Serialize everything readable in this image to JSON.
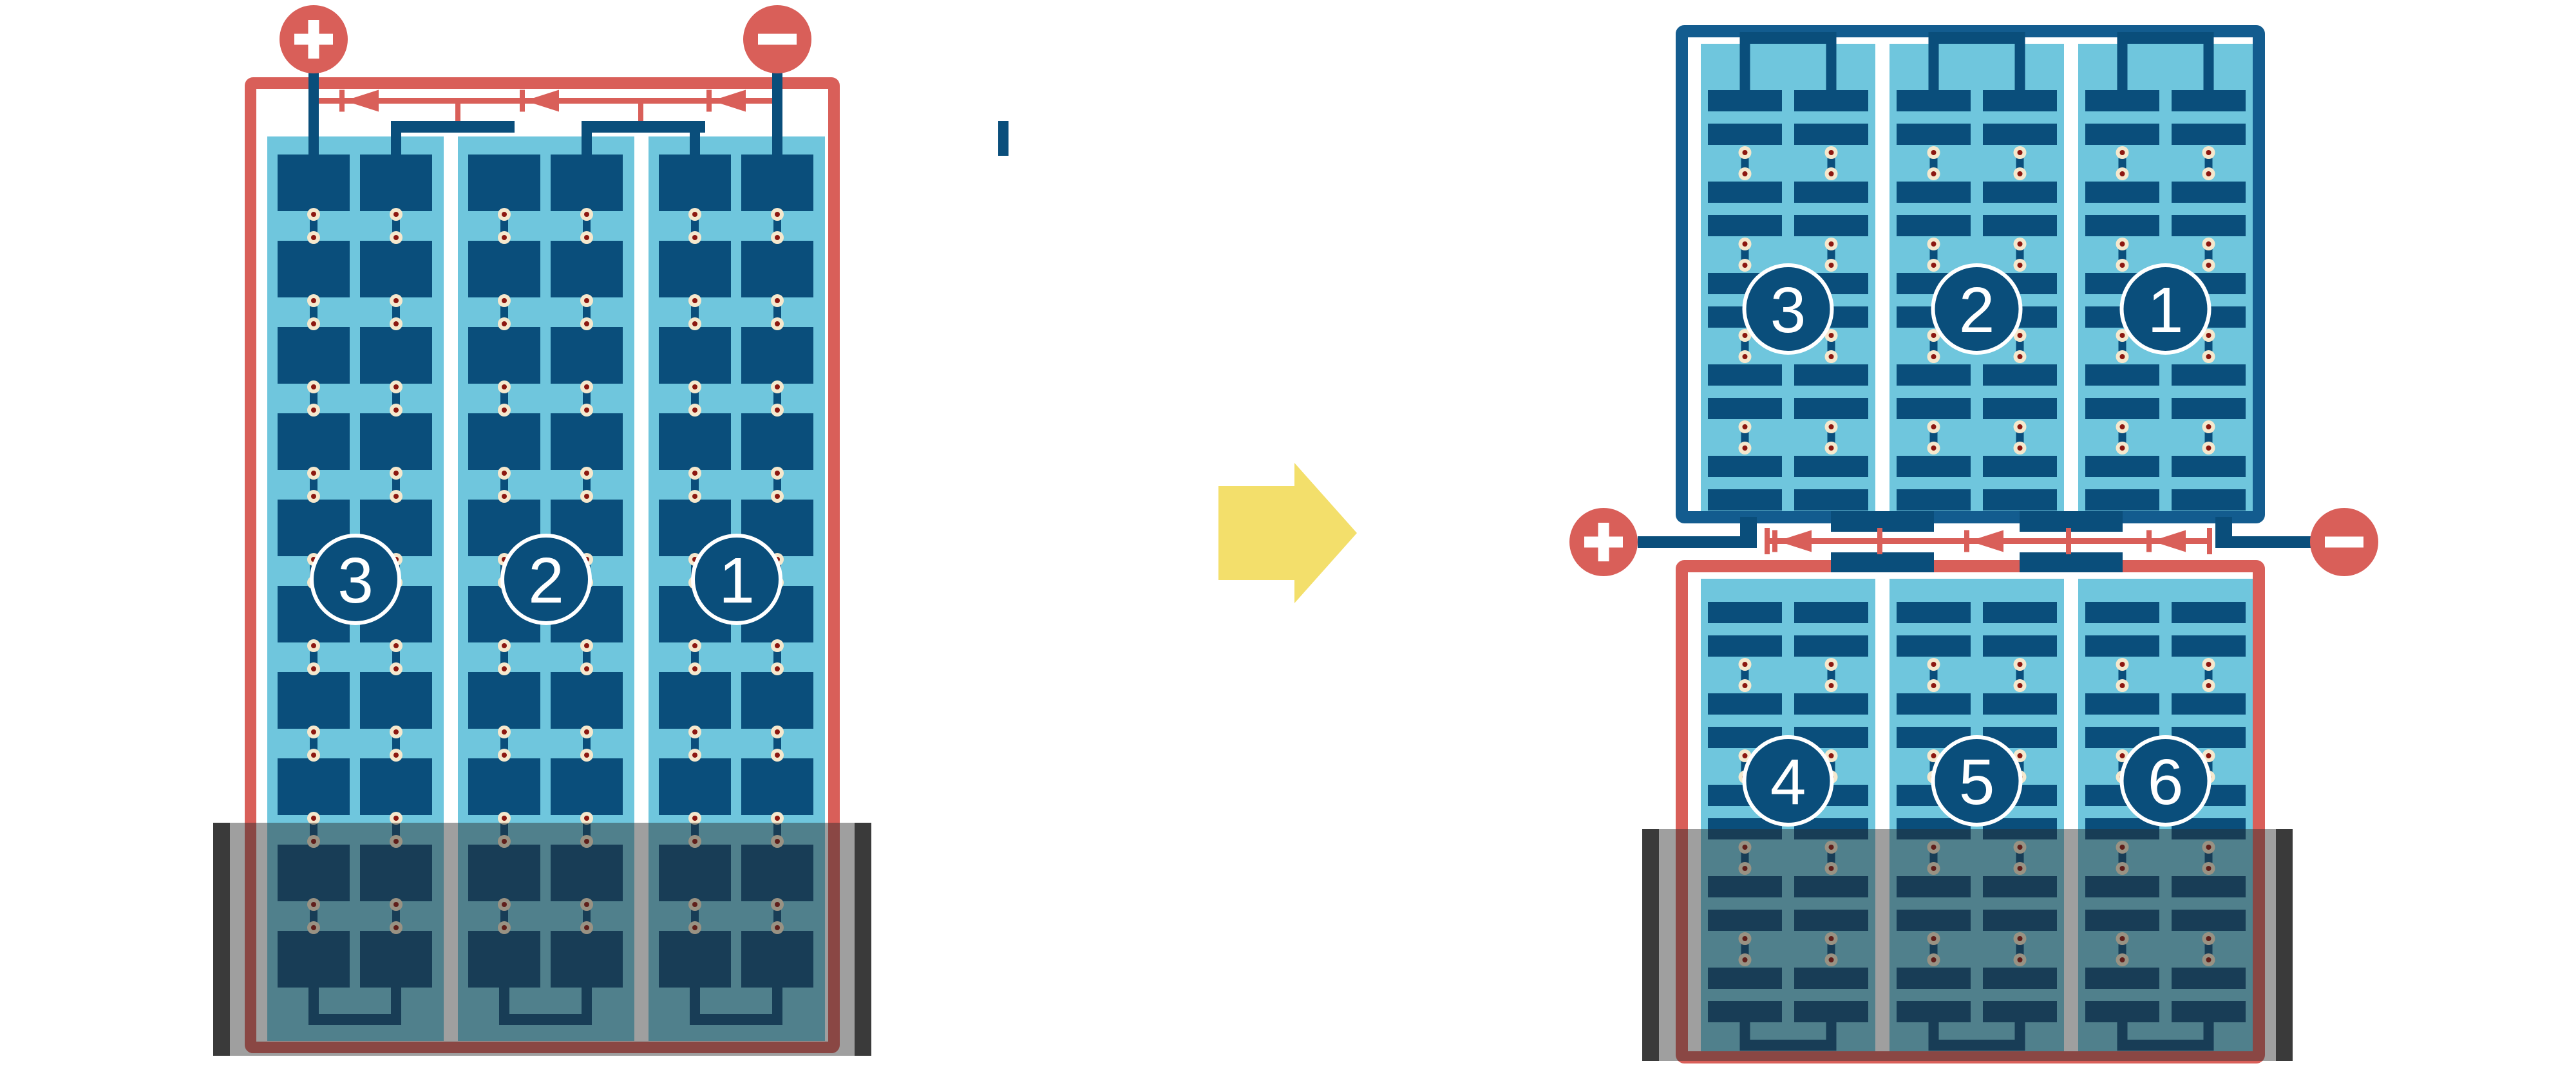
{
  "diagram_title_visible_text": [],
  "colors": {
    "red": "#D95F59",
    "cell_blue": "#0A4E7B",
    "frame_blue": "#135C8F",
    "light_blue": "#6FC6DD",
    "cream": "#F5E8CD",
    "dot_red": "#8C1710",
    "arrow_yellow": "#F3DF6B",
    "shade_bar": "#3A3A3A",
    "shade_overlay": "rgba(43,43,43,0.45)",
    "white": "#FFFFFF"
  },
  "left_panel": {
    "string_labels": [
      "3",
      "2",
      "1"
    ],
    "string_count": 3,
    "cell_rows": 10,
    "cell_columns": 6,
    "bypass_diode_count": 3,
    "terminals": {
      "positive_label": "+",
      "negative_label": "−"
    },
    "shaded_region": "bottom"
  },
  "right_panel": {
    "top_half_string_labels": [
      "3",
      "2",
      "1"
    ],
    "bottom_half_string_labels": [
      "4",
      "5",
      "6"
    ],
    "string_count": 6,
    "half_cell_rows_per_half": 10,
    "bypass_diode_count": 3,
    "terminals": {
      "positive_label": "+",
      "negative_label": "−"
    },
    "shaded_region": "bottom"
  },
  "transition_arrow": {
    "direction": "right"
  }
}
